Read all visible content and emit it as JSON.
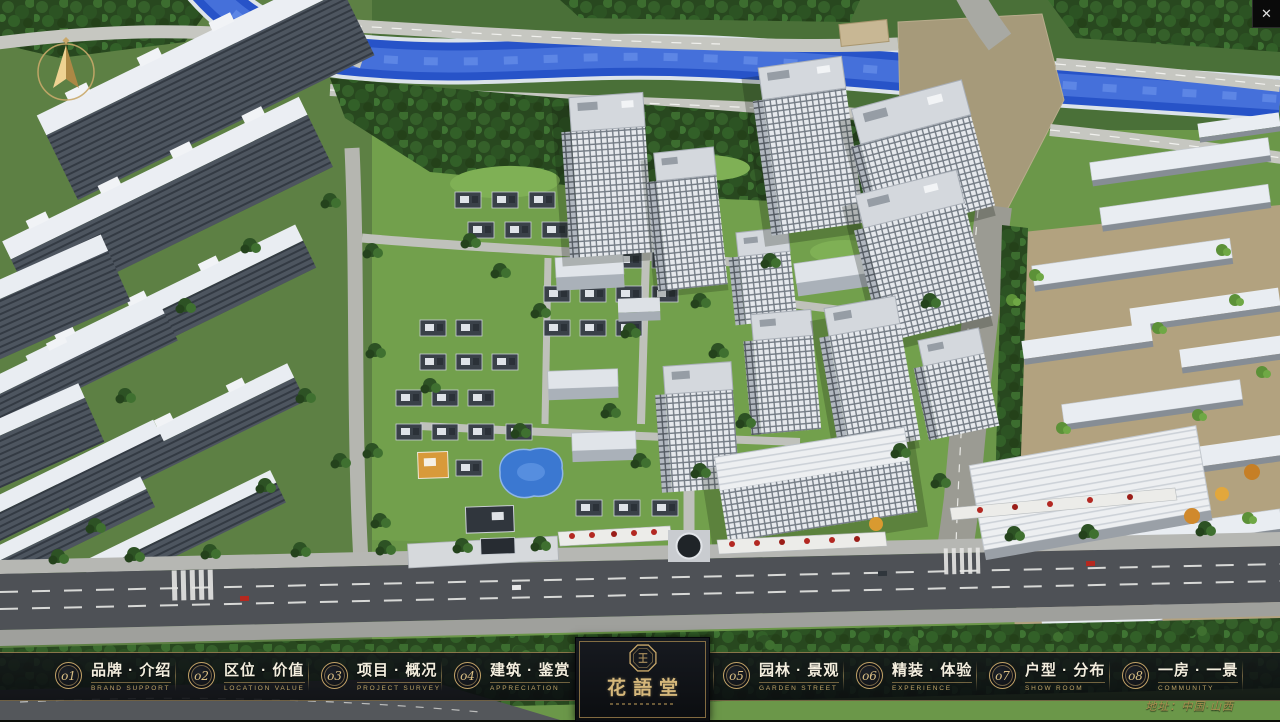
{
  "window": {
    "close_glyph": "✕"
  },
  "colors": {
    "accent_gold": "#c9a86a",
    "bar_background": "#101319",
    "river_blue": "#2b55c8",
    "close_button_bg": "#0a0a0a"
  },
  "nav": {
    "items": [
      {
        "num": "o1",
        "label": "品牌 · 介绍",
        "sub": "BRAND SUPPORT"
      },
      {
        "num": "o2",
        "label": "区位 · 价值",
        "sub": "LOCATION VALUE"
      },
      {
        "num": "o3",
        "label": "项目 · 概况",
        "sub": "PROJECT SURVEY"
      },
      {
        "num": "o4",
        "label": "建筑 · 鉴赏",
        "sub": "APPRECIATION"
      },
      {
        "num": "o5",
        "label": "园林 · 景观",
        "sub": "GARDEN STREET"
      },
      {
        "num": "o6",
        "label": "精装 · 体验",
        "sub": "EXPERIENCE"
      },
      {
        "num": "o7",
        "label": "户型 · 分布",
        "sub": "SHOW ROOM"
      },
      {
        "num": "o8",
        "label": "一房 · 一景",
        "sub": "COMMUNITY"
      }
    ]
  },
  "logo": {
    "title": "花語堂"
  },
  "footer": {
    "address": "地址：中国·山西"
  }
}
